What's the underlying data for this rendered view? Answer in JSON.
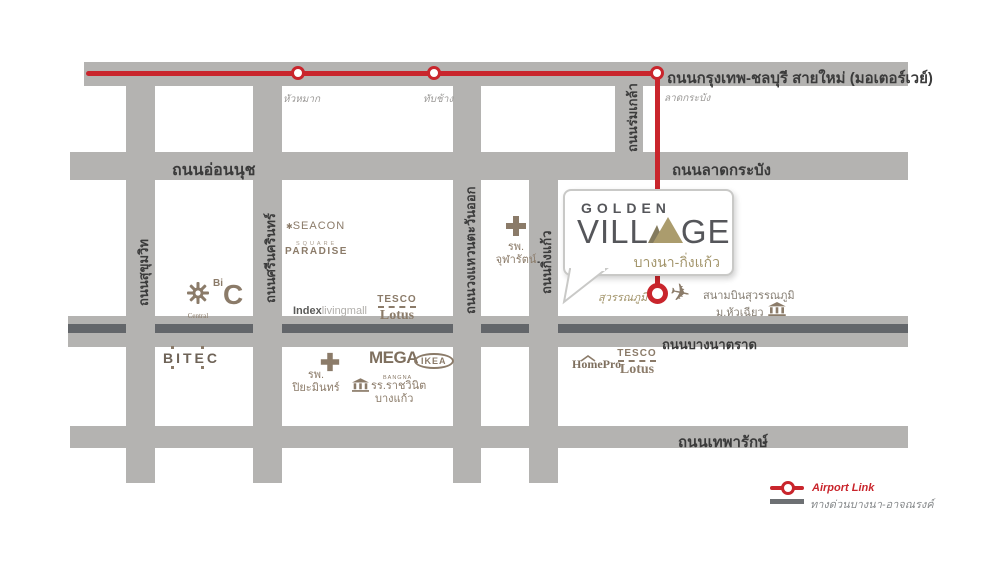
{
  "title": "Golden Village Bangna-Kingkaew location map",
  "colors": {
    "road_gray": "#b4b3b1",
    "expressway_dark": "#63666a",
    "airport_link_red": "#c9252c",
    "landmark_taupe": "#8b7b69",
    "brand_dark": "#55565a",
    "brand_gold": "#ab9c6d"
  },
  "roads": {
    "motorway": "ถนนกรุงเทพ-ชลบุรี สายใหม่ (มอเตอร์เวย์)",
    "onnut": "ถนนอ่อนนุช",
    "latkrabang": "ถนนลาดกระบัง",
    "bangnatrad": "ถนนบางนาตราด",
    "thepharak": "ถนนเทพารักษ์",
    "sukhumvit": "ถนนสุขุมวิท",
    "srinagarindra": "ถนนศรีนครินทร์",
    "ringroad": "ถนนวงแหวนตะวันออก",
    "kingkaew": "ถนนกิ่งแก้ว",
    "romklao": "ถนนร่มเกล้า"
  },
  "airport_link": {
    "stations": {
      "huamak": "หัวหมาก",
      "tabchang": "ทับช้าง",
      "latkrabang": "ลาดกระบัง",
      "suvarnabhumi": "สุวรรณภูมิ"
    }
  },
  "landmarks": {
    "central": "Central",
    "bigc_bi": "Bi",
    "bigc_c": "C",
    "seacon_line1": "SEACON",
    "seacon_line2": "SQUARE",
    "paradise": "PARADISE",
    "index_bold": "Index",
    "index_light": "livingmall",
    "tesco": "TESCO",
    "lotus": "Lotus",
    "chularat_line1": "รพ.",
    "chularat_line2": "จุฬารัตน์",
    "airport": "สนามบินสุวรรณภูมิ",
    "huachiew": "ม.หัวเฉียว",
    "bitec": "BITEC",
    "piyamin_line1": "รพ.",
    "piyamin_line2": "ปิยะมินทร์",
    "mega": "MEGA",
    "mega_sub": "BANGNA",
    "ikea": "IKEA",
    "school_line1": "รร.ราชวินิต",
    "school_line2": "บางแก้ว",
    "homepro": "HomePro"
  },
  "callout": {
    "brand_top": "GOLDEN",
    "brand_part1": "VILL",
    "brand_part2": "GE",
    "subtitle": "บางนา-กิ่งแก้ว"
  },
  "legend": {
    "airport_link": "Airport Link",
    "expressway": "ทางด่วนบางนา-อาจณรงค์"
  }
}
